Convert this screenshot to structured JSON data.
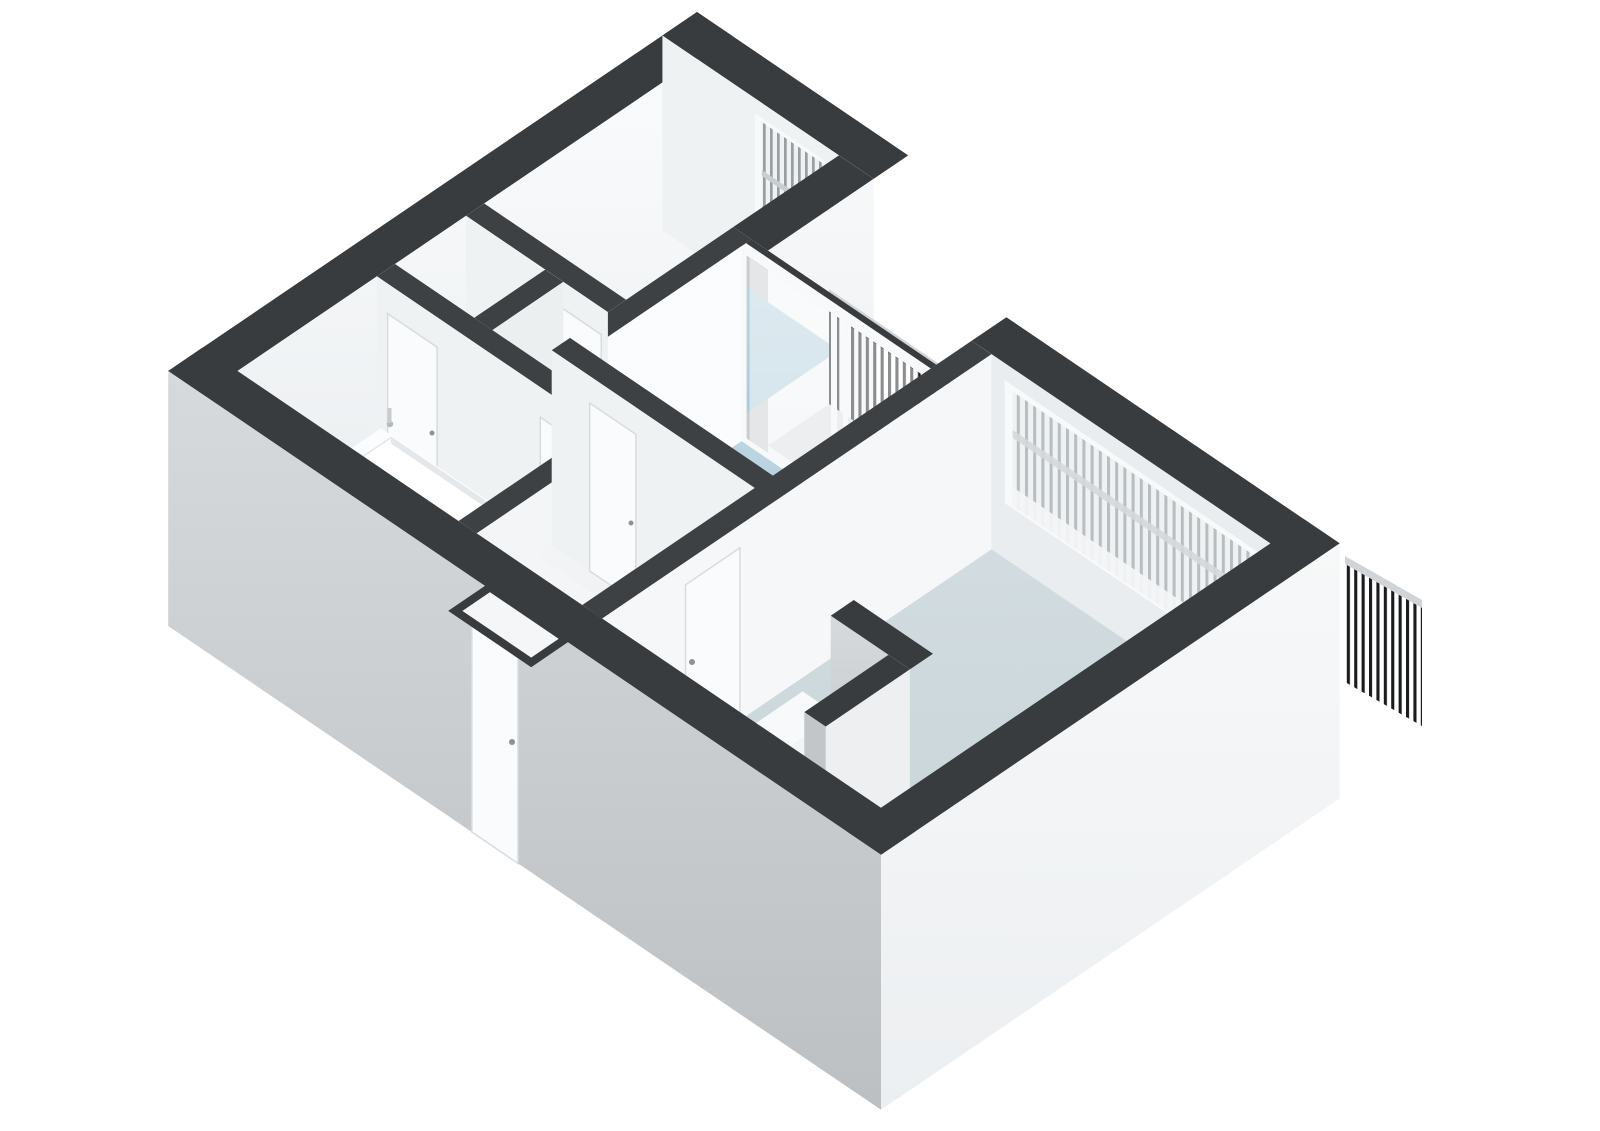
{
  "figure_type": "3d-floor-plan-render",
  "title": "",
  "colors": {
    "background": "#ffffff",
    "wall_top_dark": "#383c3f",
    "wall_top_interior": "#3d4144",
    "wall_white": "#fbfcfd",
    "wall_light": "#eff2f3",
    "wall_shade": "#e9edef",
    "wall_gray": "#c9cdcf",
    "facade_sw_light": "#d7dadc",
    "facade_sw_dark": "#bcc0c2",
    "facade_se_light": "#f7f8f9",
    "facade_se_dark": "#eceff1",
    "floor_blue_light": "#bdd5e1",
    "floor_blue_dark": "#a7c6d6",
    "floor_pale_light": "#d2dce0",
    "floor_pale_dark": "#c5d2d7",
    "floor_white_light": "#f3f4f5",
    "floor_white_dark": "#e8ebed",
    "bath_blue_light": "#38a9da",
    "bath_blue_dark": "#2187bd",
    "railing_dark": "#191b1c",
    "railing_gray": "#989ea1",
    "railing_light": "#b7bdc0",
    "rail_top": "#d2d5d7",
    "frame_white": "#f7f9fa",
    "glass": "#eef2f3",
    "glass_teal": "#d6e5e6",
    "door_white": "#fafbfc",
    "door_edge": "#d8dcde",
    "handle_gray": "#8d9396",
    "fixture_white": "#fbfcfd",
    "fixture_shadow": "#e4e8ea",
    "balcony_floor": "#d9dddf"
  },
  "scene": {
    "rooms": [
      {
        "id": "bedroom-1",
        "position": "top-left",
        "floor_color_key": "floor_blue_light"
      },
      {
        "id": "bedroom-2",
        "position": "middle",
        "floor_color_key": "floor_blue_light"
      },
      {
        "id": "living-room",
        "position": "right",
        "floor_color_key": "floor_pale_light"
      },
      {
        "id": "bathroom",
        "position": "left",
        "floor_color_key": "bath_blue_light"
      },
      {
        "id": "closet-1",
        "position": "left-center",
        "floor_color_key": "floor_white_light"
      },
      {
        "id": "closet-2",
        "position": "left-center",
        "floor_color_key": "floor_white_light"
      },
      {
        "id": "hallway",
        "position": "center",
        "floor_color_key": "floor_white_light"
      },
      {
        "id": "balcony",
        "position": "top-center",
        "floor_color_key": "balcony_floor"
      }
    ],
    "fixtures": [
      {
        "id": "bathtub",
        "room": "bathroom"
      },
      {
        "id": "washbasin",
        "room": "bathroom"
      },
      {
        "id": "kitchen-counter",
        "room": "living-room"
      },
      {
        "id": "duct-wall",
        "room": "living-room"
      },
      {
        "id": "cabinet-box",
        "room": "living-room"
      }
    ],
    "openings": [
      {
        "id": "bedroom-1-window",
        "wall": "north-east",
        "railing": "gray-slats"
      },
      {
        "id": "bedroom-2-sliding-door",
        "wall": "north-east",
        "railing": "black-slats-balcony"
      },
      {
        "id": "living-room-window",
        "wall": "north-east",
        "railing": "light-slats"
      },
      {
        "id": "corner-railing",
        "wall": "south-east"
      },
      {
        "id": "door-bedroom-1",
        "type": "interior-door"
      },
      {
        "id": "door-bedroom-2",
        "type": "interior-door"
      },
      {
        "id": "door-living-room",
        "type": "interior-door"
      },
      {
        "id": "door-bathroom",
        "type": "interior-door"
      },
      {
        "id": "closet-double-doors",
        "type": "interior-door"
      },
      {
        "id": "front-door",
        "type": "entrance-door"
      },
      {
        "id": "entry-niche",
        "type": "recess"
      }
    ]
  }
}
